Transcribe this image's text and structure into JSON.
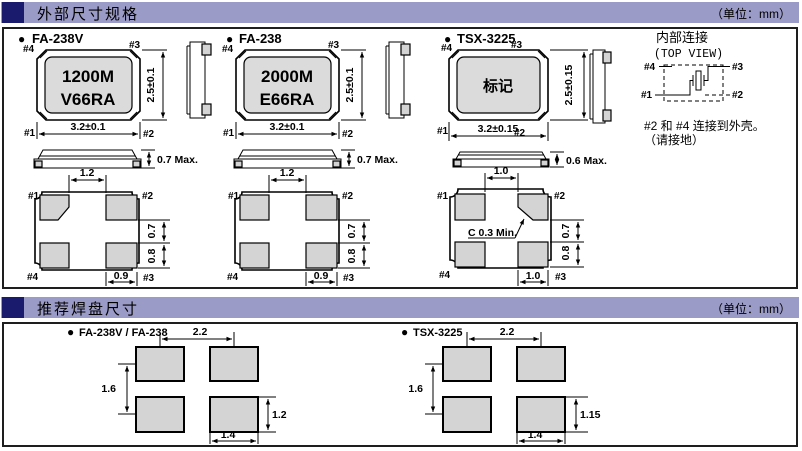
{
  "icons": {
    "bullet": "●"
  },
  "sections": {
    "external": {
      "title": "外部尺寸规格",
      "unit": "（单位：mm）"
    },
    "land": {
      "title": "推荐焊盘尺寸",
      "unit": "（单位：mm）"
    }
  },
  "pins": {
    "p1": "#1",
    "p2": "#2",
    "p3": "#3",
    "p4": "#4"
  },
  "packages": {
    "fa238v": {
      "name": "FA-238V",
      "marking1": "1200M",
      "marking2": "V66RA",
      "dim_width": "3.2±0.1",
      "dim_height": "2.5±0.1",
      "dim_thickness": "0.7 Max.",
      "dim_top_gap": "1.2",
      "dim_pad_gap": "0.7",
      "dim_pad_h": "0.8",
      "dim_pad_w": "0.9"
    },
    "fa238": {
      "name": "FA-238",
      "marking1": "2000M",
      "marking2": "E66RA",
      "dim_width": "3.2±0.1",
      "dim_height": "2.5±0.1",
      "dim_thickness": "0.7 Max.",
      "dim_top_gap": "1.2",
      "dim_pad_gap": "0.7",
      "dim_pad_h": "0.8",
      "dim_pad_w": "0.9"
    },
    "tsx3225": {
      "name": "TSX-3225",
      "marking": "标记",
      "dim_width": "3.2±0.15",
      "dim_height": "2.5±0.15",
      "dim_thickness": "0.6 Max.",
      "dim_top_gap": "1.0",
      "dim_pad_gap": "0.7",
      "dim_pad_h": "0.8",
      "dim_pad_w": "1.0",
      "chamfer_note": "C 0.3 Min."
    }
  },
  "internal_connection": {
    "title": "内部连接",
    "subtitle": "(TOP VIEW)",
    "note1": "#2 和 #4 连接到外壳。",
    "note2": "（请接地）"
  },
  "land_patterns": {
    "fa": {
      "name": "FA-238V / FA-238",
      "pitch_x": "2.2",
      "pitch_y": "1.6",
      "pad_h": "1.2",
      "pad_w": "1.4"
    },
    "tsx": {
      "name": "TSX-3225",
      "pitch_x": "2.2",
      "pitch_y": "1.6",
      "pad_h": "1.15",
      "pad_w": "1.4"
    }
  }
}
